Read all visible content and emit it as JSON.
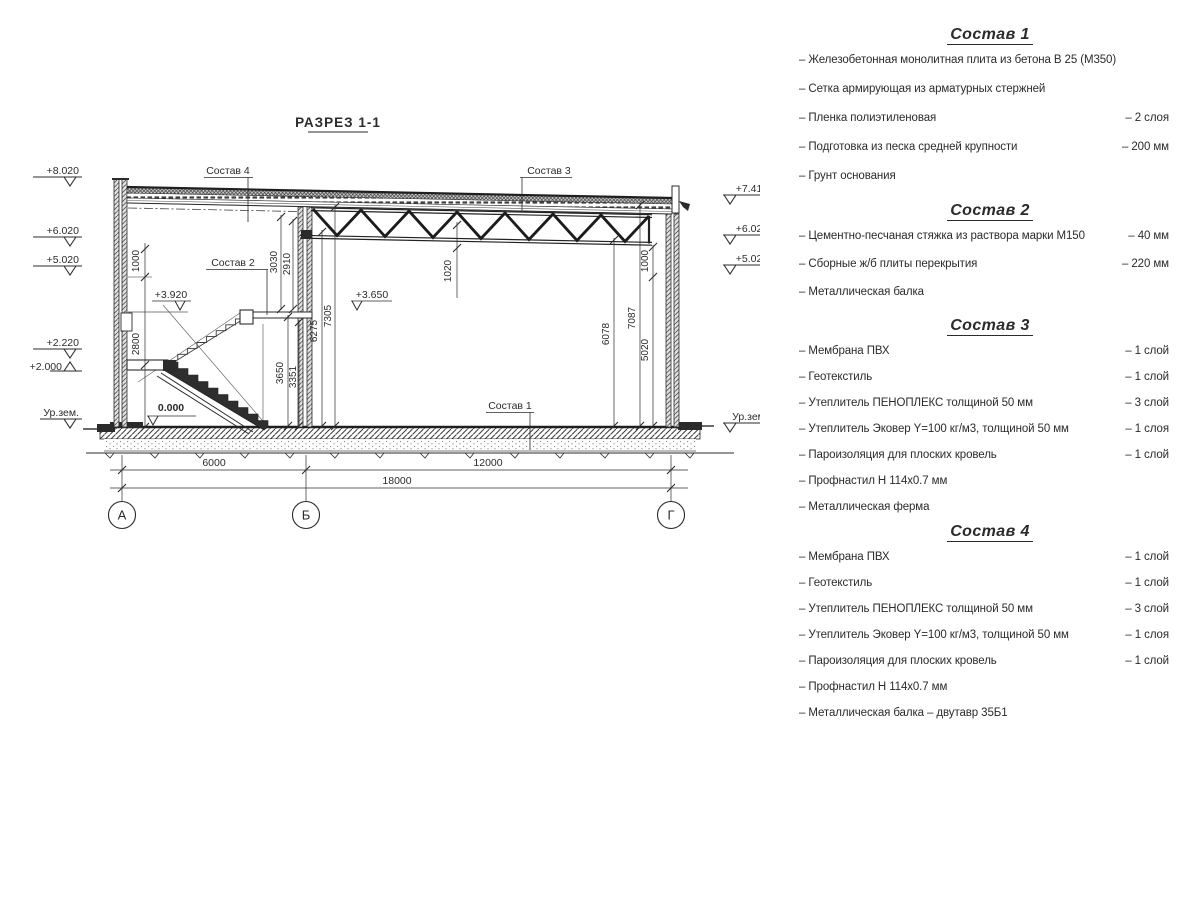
{
  "title": "РАЗРЕЗ 1-1",
  "axes": {
    "a": "А",
    "b": "Б",
    "g": "Г"
  },
  "dims": {
    "h6000": "6000",
    "h12000": "12000",
    "h18000": "18000",
    "v1000_left": "1000",
    "v2800": "2800",
    "v3030": "3030",
    "v2910": "2910",
    "v3650": "3650",
    "v3351": "3351",
    "v6275": "6275",
    "v7305": "7305",
    "v1020": "1020",
    "v6078": "6078",
    "v7087": "7087",
    "v5020": "5020",
    "v1000_right": "1000"
  },
  "elev": {
    "l1": "+8.020",
    "l2": "+6.020",
    "l3": "+5.020",
    "l4": "+2.220",
    "l5": "+2.000",
    "ground_left": "Ур.зем.",
    "r1": "+7.410",
    "r2": "+6.020",
    "r3": "+5.020",
    "ground_right": "Ур.зем.",
    "mid_3920": "+3.920",
    "mid_3650": "+3.650",
    "zero": "0.000"
  },
  "callouts": {
    "c1": "Состав 1",
    "c2": "Состав 2",
    "c3": "Состав 3",
    "c4": "Состав 4"
  },
  "lists": [
    {
      "title": "Состав 1",
      "items": [
        {
          "label": "– Железобетонная  монолитная плита из бетона В 25 (М350)",
          "value": ""
        },
        {
          "label": "– Сетка армирующая из арматурных стержней",
          "value": ""
        },
        {
          "label": "– Пленка полиэтиленовая",
          "value": "–  2 слоя"
        },
        {
          "label": "– Подготовка из песка средней крупности",
          "value": "– 200 мм"
        },
        {
          "label": "– Грунт основания",
          "value": ""
        }
      ]
    },
    {
      "title": "Состав 2",
      "items": [
        {
          "label": "– Цементно-песчаная стяжка из раствора марки М150",
          "value": "– 40 мм"
        },
        {
          "label": "– Сборные ж/б плиты перекрытия",
          "value": "– 220 мм"
        },
        {
          "label": "– Металлическая балка",
          "value": ""
        }
      ]
    },
    {
      "title": "Состав 3",
      "items": [
        {
          "label": "– Мембрана ПВХ",
          "value": "– 1 слой"
        },
        {
          "label": "– Геотекстиль",
          "value": "– 1 слой"
        },
        {
          "label": "– Утеплитель ПЕНОПЛЕКС толщиной 50 мм",
          "value": "– 3 слой"
        },
        {
          "label": "– Утеплитель Эковер Y=100 кг/м3, толщиной 50 мм",
          "value": "– 1 слоя"
        },
        {
          "label": "– Пароизоляция для плоских кровель",
          "value": "– 1 слой"
        },
        {
          "label": "– Профнастил Н 114х0.7 мм",
          "value": ""
        },
        {
          "label": "– Металлическая ферма",
          "value": ""
        }
      ]
    },
    {
      "title": "Состав 4",
      "items": [
        {
          "label": "– Мембрана ПВХ",
          "value": "– 1 слой"
        },
        {
          "label": "– Геотекстиль",
          "value": "– 1 слой"
        },
        {
          "label": "– Утеплитель ПЕНОПЛЕКС толщиной 50 мм",
          "value": "– 3 слой"
        },
        {
          "label": "– Утеплитель Эковер Y=100 кг/м3, толщиной 50 мм",
          "value": "– 1 слоя"
        },
        {
          "label": "– Пароизоляция для плоских кровель",
          "value": "– 1 слой"
        },
        {
          "label": "– Профнастил Н 114х0.7 мм",
          "value": ""
        },
        {
          "label": "– Металлическая балка – двутавр 35Б1",
          "value": ""
        }
      ]
    }
  ]
}
